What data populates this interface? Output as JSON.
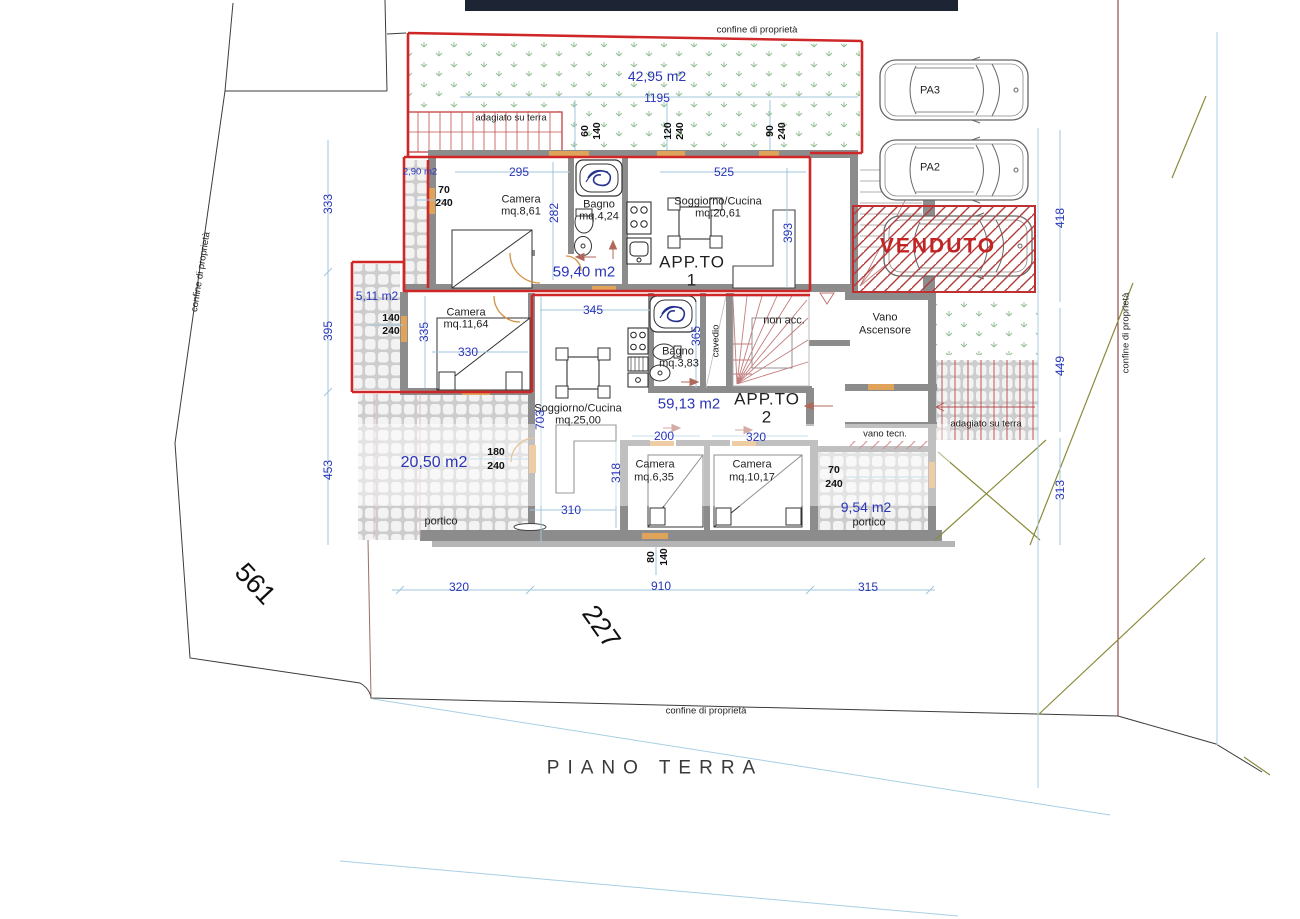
{
  "title": "PIANO TERRA",
  "boundaries": {
    "top": "confine di proprietà",
    "left": "confine di proprietà",
    "right": "confine di proprietà",
    "bottom": "confine di proprietà"
  },
  "parcels": {
    "left": "561",
    "center": "227"
  },
  "garden": {
    "area": "42,95 m2"
  },
  "strips": {
    "top": "adagiato su terra",
    "right": "adagiato su terra",
    "area_small": "2,90 m2",
    "area_mid": "5,11 m2"
  },
  "parking": {
    "pa3": "PA3",
    "pa2": "PA2",
    "sold": "VENDUTO"
  },
  "apt1": {
    "name": "APP.TO",
    "num": "1",
    "area": "59,40 m2",
    "camera": "Camera",
    "camera_mq": "mq.8,61",
    "bagno": "Bagno",
    "bagno_mq": "mq.4,24",
    "sogg": "Soggiorno/Cucina",
    "sogg_mq": "mq.20,61"
  },
  "apt2": {
    "name": "APP.TO",
    "num": "2",
    "area": "59,13 m2",
    "camera1": "Camera",
    "camera1_mq": "mq.11,64",
    "sogg": "Soggiorno/Cucina",
    "sogg_mq": "mq.25,00",
    "bagno": "Bagno",
    "bagno_mq": "mq.3,83",
    "camera2": "Camera",
    "camera2_mq": "mq.6,35",
    "camera3": "Camera",
    "camera3_mq": "mq.10,17"
  },
  "rooms": {
    "vano1": "Vano",
    "vano2": "Ascensore",
    "non_acc": "non acc.",
    "cavedio": "cavedio",
    "vano_tecn": "vano tecn.",
    "portico": "portico",
    "portico_l_area": "20,50 m2",
    "portico_r_area": "9,54 m2"
  },
  "dims": {
    "d1195": "1195",
    "d295": "295",
    "d282": "282",
    "d525": "525",
    "d393": "393",
    "d333": "333",
    "d395": "395",
    "d453": "453",
    "d335": "335",
    "d330": "330",
    "d345": "345",
    "d365": "365",
    "d703": "703",
    "d318": "318",
    "d310": "310",
    "d200": "200",
    "d320a": "320",
    "d320b": "320",
    "d910": "910",
    "d315": "315",
    "d418": "418",
    "d449": "449",
    "d313": "313",
    "p60_140": [
      "60",
      "140"
    ],
    "p120_240": [
      "120",
      "240"
    ],
    "p90_240": [
      "90",
      "240"
    ],
    "p70_240a": [
      "70",
      "240"
    ],
    "p140_240": [
      "140",
      "240"
    ],
    "p180_240": [
      "180",
      "240"
    ],
    "p70_240b": [
      "70",
      "240"
    ],
    "p80_140": [
      "80",
      "140"
    ]
  }
}
